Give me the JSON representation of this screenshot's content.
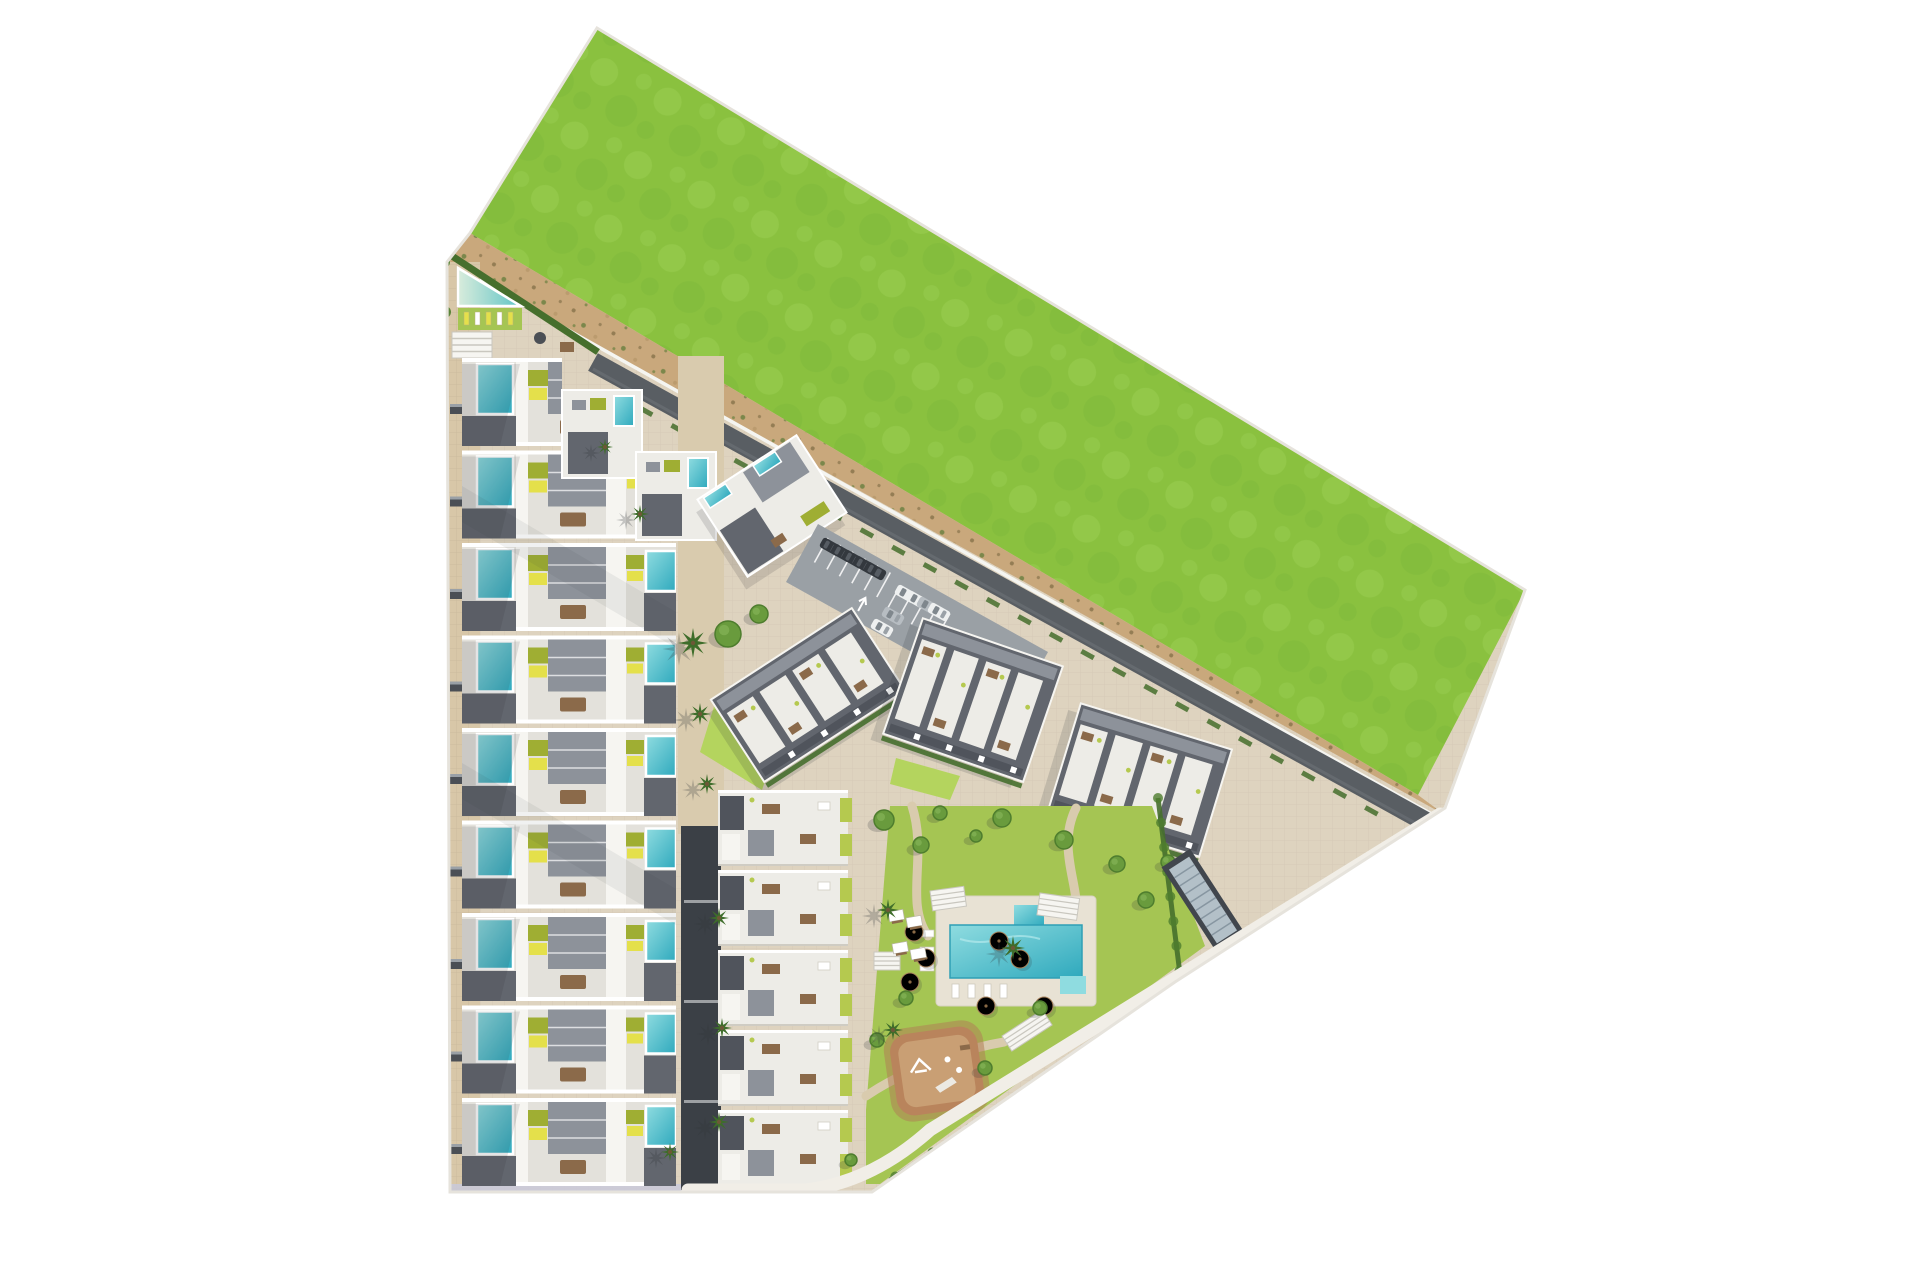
{
  "scene": {
    "description": "aerial-3d-site-plan-render-of-residential-development-with-green-field",
    "canvas": {
      "w": 1920,
      "h": 1280
    }
  },
  "palette": {
    "bg": "#ffffff",
    "base": "#ded3bf",
    "paver": "#d8c7a8",
    "walk_beige": "#d9cbae",
    "alley_dark": "#3b4046",
    "field": "#8ac13f",
    "field_light": "#9bd054",
    "field_dark": "#79b338",
    "dirt": "#c9a87c",
    "dirt_dark": "#7d6b43",
    "dirt_green": "#5a7a36",
    "road": "#595e63",
    "fence": "#f5f5f1",
    "roof_white": "#edece7",
    "roof_white2": "#f6f5f1",
    "roof_gray": "#8d929a",
    "roof_gray_dark": "#62666e",
    "roof_gray_darker": "#50545c",
    "pool_teal": "#4fbfc4",
    "pool_teal_deep": "#2fa9bd",
    "pool_light": "#8fdce0",
    "lap_beach": "#d9ecdc",
    "lap_teal": "#5fc4c6",
    "olive": "#9fae33",
    "lime": "#b5c94f",
    "lounger_yellow": "#e4e04b",
    "hedge": "#466f2d",
    "lawn": "#a5c553",
    "lawn_bright": "#b4d45e",
    "tree": "#699b3d",
    "tree_dark": "#4e7d2e",
    "palm": "#3e6d2a",
    "playground": "#b9845c",
    "playground_inner": "#c99f74",
    "furn_brown": "#8b6a4a",
    "furn_dark": "#4b4f55",
    "car_dark": "#33383e",
    "car_white": "#eef0f0",
    "car_silver": "#b7bdc2",
    "ramp_dark": "#41464d",
    "ramp_stripe": "#b3c0c8",
    "lavender_walk": "#c9c9da",
    "boundary_walk": "#f1eee7",
    "shadow": "#2e3238"
  },
  "site": {
    "outline": [
      [
        597,
        28
      ],
      [
        1525,
        590
      ],
      [
        1445,
        808
      ],
      [
        1175,
        982
      ],
      [
        872,
        1192
      ],
      [
        450,
        1192
      ],
      [
        447,
        262
      ],
      [
        470,
        233
      ]
    ],
    "field": [
      [
        597,
        28
      ],
      [
        1525,
        590
      ],
      [
        1418,
        795
      ],
      [
        470,
        233
      ]
    ],
    "dirt_strip": [
      [
        470,
        233
      ],
      [
        1418,
        795
      ],
      [
        1445,
        815
      ],
      [
        447,
        262
      ]
    ],
    "fence_line": [
      447,
      262,
      1437,
      817
    ],
    "road": {
      "x1": 593,
      "y1": 362,
      "x2": 1437,
      "y2": 828,
      "width": 20
    },
    "road_hedge": [
      640,
      408,
      1388,
      820
    ],
    "left_street": {
      "x": 447,
      "w": 33,
      "y1": 262,
      "y2": 1192
    },
    "bins": {
      "x": 450,
      "y0": 404,
      "step": 92.5,
      "count": 9
    },
    "lavender_strip": [
      450,
      1184,
      312,
      9
    ],
    "boundary_walk_path": "M 688,1190 L 806,1190 Q 872,1182 930,1130 L 1440,814"
  },
  "amenity_corner": {
    "hedge": [
      452,
      256,
      598,
      352
    ],
    "lap_pool": [
      [
        458,
        268
      ],
      [
        521,
        306
      ],
      [
        458,
        306
      ]
    ],
    "lawn": [
      458,
      308,
      64,
      22
    ],
    "loungers": {
      "x0": 464,
      "y": 312,
      "step": 11,
      "count": 5
    },
    "pergola": [
      452,
      332,
      40,
      26
    ],
    "table_round": [
      540,
      338
    ],
    "table_rect": [
      560,
      342,
      14,
      10
    ],
    "bushes": [
      [
        444,
        262
      ],
      [
        441,
        286
      ],
      [
        445,
        312
      ],
      [
        442,
        338
      ]
    ]
  },
  "rowhouses_a": {
    "x": 462,
    "top": 358,
    "pitch": 92.5,
    "count": 9,
    "height": 88,
    "widths": [
      100,
      178,
      214,
      214,
      214,
      214,
      214,
      214,
      214
    ],
    "shade_bands": [
      [
        [
          462,
          486
        ],
        [
          676,
          612
        ],
        [
          676,
          648
        ],
        [
          462,
          522
        ]
      ],
      [
        [
          462,
          763
        ],
        [
          676,
          889
        ],
        [
          676,
          925
        ],
        [
          462,
          799
        ]
      ]
    ]
  },
  "step_units": [
    [
      562,
      390
    ],
    [
      636,
      452
    ]
  ],
  "rotated_unit": {
    "cx": 772,
    "cy": 506,
    "w": 118,
    "h": 92,
    "rot": -33
  },
  "walkway": {
    "beige": [
      678,
      356,
      46,
      478
    ],
    "alley": [
      681,
      826,
      40,
      364
    ],
    "dash_ys": [
      900,
      1000,
      1100
    ]
  },
  "parking": {
    "poly": [
      [
        818,
        524
      ],
      [
        1048,
        652
      ],
      [
        1016,
        710
      ],
      [
        786,
        582
      ]
    ],
    "dir": [
      0.875,
      0.484
    ],
    "stalls_top": {
      "x0": 828,
      "y0": 538,
      "step": 12.5,
      "count": 6,
      "len": 28
    },
    "stalls_mid": {
      "x0": 900,
      "y0": 586,
      "step": 12.5,
      "count": 5,
      "len": 28
    },
    "cars": [
      {
        "x": 831,
        "y": 547,
        "rot": 119,
        "c": "car_dark"
      },
      {
        "x": 842,
        "y": 553,
        "rot": 119,
        "c": "car_dark"
      },
      {
        "x": 853,
        "y": 559,
        "rot": 119,
        "c": "car_dark"
      },
      {
        "x": 864,
        "y": 565,
        "rot": 119,
        "c": "car_dark"
      },
      {
        "x": 875,
        "y": 571,
        "rot": 119,
        "c": "car_dark"
      },
      {
        "x": 906,
        "y": 594,
        "rot": -61,
        "c": "car_white"
      },
      {
        "x": 917,
        "y": 600,
        "rot": -61,
        "c": "car_white"
      },
      {
        "x": 928,
        "y": 606,
        "rot": -61,
        "c": "car_silver"
      },
      {
        "x": 939,
        "y": 612,
        "rot": -61,
        "c": "car_white"
      },
      {
        "x": 893,
        "y": 616,
        "rot": -61,
        "c": "car_silver"
      },
      {
        "x": 882,
        "y": 628,
        "rot": -61,
        "c": "car_white"
      }
    ],
    "arrows": [
      {
        "x": 862,
        "y": 604,
        "rot": 29
      },
      {
        "x": 978,
        "y": 664,
        "rot": 209
      }
    ]
  },
  "blocks": [
    {
      "cx": 808,
      "cy": 695,
      "w": 168,
      "h": 98,
      "rot": -33,
      "units": 4
    },
    {
      "cx": 973,
      "cy": 700,
      "w": 148,
      "h": 122,
      "rot": 19,
      "units": 4
    },
    {
      "cx": 1140,
      "cy": 780,
      "w": 158,
      "h": 112,
      "rot": 17,
      "units": 4
    }
  ],
  "block_lawns": [
    [
      [
        716,
        700
      ],
      [
        780,
        736
      ],
      [
        762,
        790
      ],
      [
        700,
        752
      ]
    ],
    [
      [
        896,
        758
      ],
      [
        960,
        776
      ],
      [
        950,
        800
      ],
      [
        890,
        784
      ]
    ]
  ],
  "rowhouses_b": {
    "x": 718,
    "top": 790,
    "pitch": 80,
    "count": 5,
    "w": 130,
    "height": 76
  },
  "garden": {
    "lawn": [
      [
        890,
        806
      ],
      [
        1152,
        806
      ],
      [
        1205,
        946
      ],
      [
        880,
        1184
      ],
      [
        866,
        1184
      ],
      [
        866,
        1110
      ]
    ],
    "paths": [
      "M 912,806 C 928,856 904,902 928,936",
      "M 1076,808 C 1052,856 1092,902 1070,936",
      "M 866,1096 C 920,1060 980,1046 1004,1042"
    ],
    "deck": [
      936,
      896,
      160,
      110
    ],
    "pool_main": [
      950,
      925,
      132,
      53
    ],
    "pool_tab": [
      1014,
      905,
      30,
      22
    ],
    "pool_step": [
      1060,
      976,
      26,
      18
    ],
    "loungers_bottom": {
      "x0": 952,
      "y": 984,
      "step": 16,
      "count": 4
    },
    "loungers_left": {
      "x": 920,
      "y0": 930,
      "step": 17,
      "count": 3
    },
    "umbrellas": [
      [
        914,
        932
      ],
      [
        926,
        958
      ],
      [
        910,
        982
      ],
      [
        999,
        941
      ],
      [
        1020,
        959
      ],
      [
        986,
        1006
      ],
      [
        1044,
        1006
      ]
    ],
    "pergolas": [
      [
        930,
        891,
        34,
        20,
        -8
      ],
      [
        1040,
        893,
        40,
        22,
        8
      ],
      [
        1002,
        1036,
        48,
        18,
        -33
      ],
      [
        874,
        952,
        26,
        18,
        0
      ]
    ],
    "lawn_pads": [
      [
        888,
        912
      ],
      [
        906,
        918
      ],
      [
        892,
        944
      ],
      [
        910,
        950
      ]
    ],
    "playground": {
      "x": 893,
      "y": 1030,
      "w": 88,
      "h": 82,
      "rot": -8
    },
    "hedge_bottom": [
      1155,
      1008,
      890,
      1180
    ],
    "hedge_rightlot": [
      1158,
      798,
      1180,
      974
    ],
    "trees": [
      [
        728,
        634,
        13
      ],
      [
        759,
        614,
        9
      ],
      [
        884,
        820,
        10
      ],
      [
        921,
        845,
        8
      ],
      [
        1002,
        818,
        9
      ],
      [
        1064,
        840,
        9
      ],
      [
        1117,
        864,
        8
      ],
      [
        1146,
        900,
        8
      ],
      [
        940,
        813,
        7
      ],
      [
        976,
        836,
        6
      ],
      [
        906,
        998,
        7
      ],
      [
        1040,
        1008,
        7
      ],
      [
        877,
        1040,
        7
      ],
      [
        985,
        1068,
        7
      ],
      [
        1122,
        1028,
        8
      ],
      [
        1080,
        1060,
        8
      ],
      [
        1042,
        1090,
        7
      ],
      [
        1002,
        1120,
        7
      ],
      [
        957,
        1150,
        7
      ],
      [
        914,
        1174,
        6
      ],
      [
        1168,
        862,
        7
      ],
      [
        851,
        1160,
        6
      ]
    ],
    "palms": [
      [
        693,
        643,
        15
      ],
      [
        700,
        714,
        11
      ],
      [
        707,
        784,
        10
      ],
      [
        719,
        918,
        10
      ],
      [
        722,
        1028,
        10
      ],
      [
        719,
        1122,
        10
      ],
      [
        888,
        910,
        11
      ],
      [
        893,
        1030,
        10
      ],
      [
        1013,
        948,
        12
      ],
      [
        670,
        1152,
        9
      ],
      [
        640,
        514,
        9
      ],
      [
        605,
        447,
        8
      ]
    ]
  },
  "ramp": {
    "cx": 1203,
    "cy": 900,
    "w": 34,
    "h": 100,
    "rot": -33
  }
}
